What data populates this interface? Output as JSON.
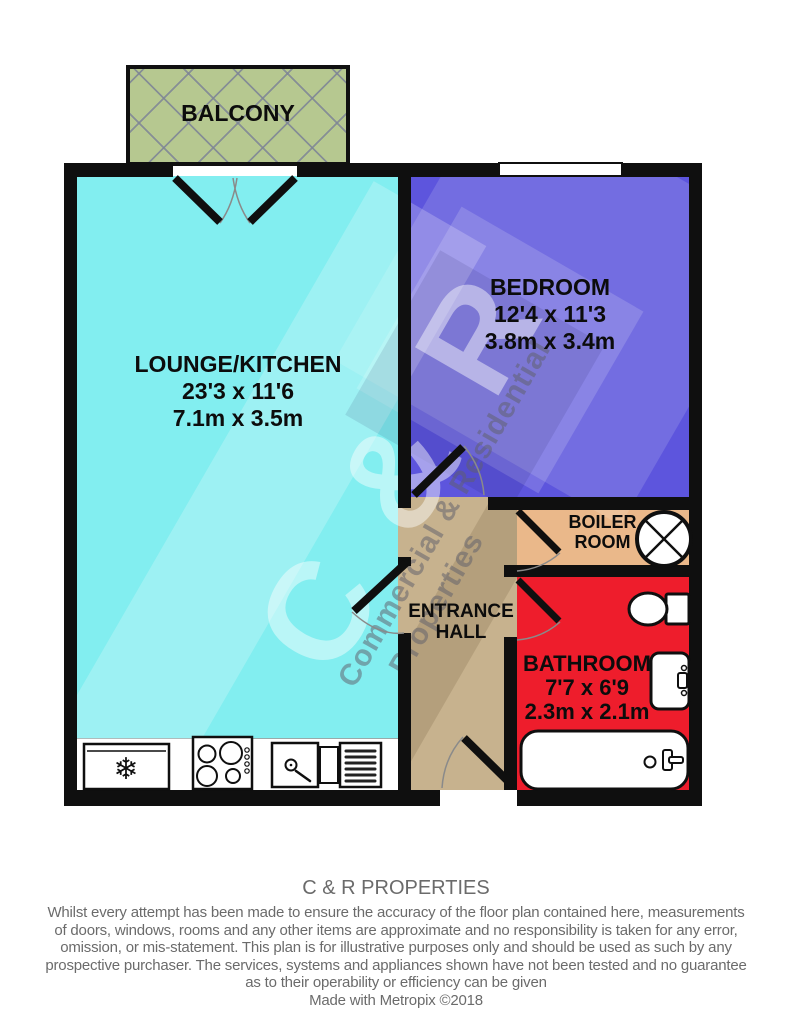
{
  "plan": {
    "rooms": {
      "balcony": {
        "label": "BALCONY"
      },
      "lounge": {
        "label": "LOUNGE/KITCHEN",
        "dims_imperial": "23'3 x 11'6",
        "dims_metric": "7.1m x 3.5m"
      },
      "bedroom": {
        "label": "BEDROOM",
        "dims_imperial": "12'4 x 11'3",
        "dims_metric": "3.8m x 3.4m"
      },
      "boiler_room": {
        "label_line1": "BOILER",
        "label_line2": "ROOM"
      },
      "entrance_hall": {
        "label_line1": "ENTRANCE",
        "label_line2": "HALL"
      },
      "bathroom": {
        "label": "BATHROOM",
        "dims_imperial": "7'7 x 6'9",
        "dims_metric": "2.3m x 2.1m"
      }
    },
    "watermark": {
      "big": "C & R",
      "line1": "Commercial & Residential",
      "line2": "Properties"
    },
    "icons": {
      "fridge_glyph": "❄"
    },
    "colors": {
      "lounge": "#82eef0",
      "bedroom": "#5d55dd",
      "entrance_hall": "#c7b28e",
      "boiler_room": "#eab88a",
      "bathroom": "#ee1d2c",
      "balcony": "#b6c890",
      "wall": "#0f0f0f"
    }
  },
  "footer": {
    "title": "C & R PROPERTIES",
    "disclaimer_lines": [
      "Whilst every attempt has been made to ensure the accuracy of the floor plan contained here, measurements",
      "of doors, windows, rooms and any other items are approximate and no responsibility is taken for any error,",
      "omission, or mis-statement. This plan is for illustrative purposes only and should be used as such by any",
      "prospective purchaser. The services, systems and appliances shown have not been tested and no guarantee",
      "as to their operability or efficiency can be given"
    ],
    "credit": "Made with Metropix ©2018"
  }
}
